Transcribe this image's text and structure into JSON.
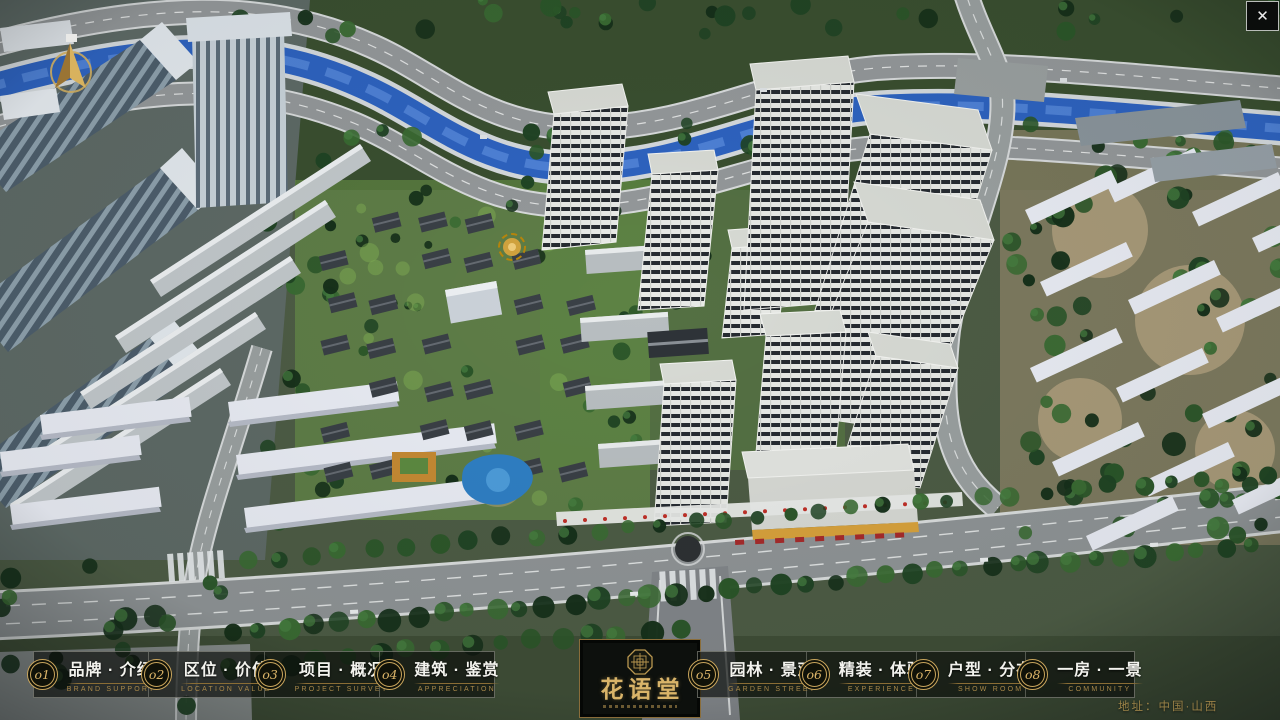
{
  "nav": {
    "items": [
      {
        "num": "o1",
        "zh": "品牌 · 介绍",
        "en": "BRAND SUPPORT"
      },
      {
        "num": "o2",
        "zh": "区位 · 价值",
        "en": "LOCATION VALUE"
      },
      {
        "num": "o3",
        "zh": "项目 · 概况",
        "en": "PROJECT SURVEY"
      },
      {
        "num": "o4",
        "zh": "建筑 · 鉴赏",
        "en": "APPRECIATION"
      },
      {
        "num": "o5",
        "zh": "园林 · 景观",
        "en": "GARDEN STREET"
      },
      {
        "num": "o6",
        "zh": "精装 · 体验",
        "en": "EXPERIENCE"
      },
      {
        "num": "o7",
        "zh": "户型 · 分布",
        "en": "SHOW ROOM"
      },
      {
        "num": "o8",
        "zh": "一房 · 一景",
        "en": "COMMUNITY"
      }
    ]
  },
  "logo": {
    "title_zh": "花语堂"
  },
  "footer": {
    "address": "地址：中国·山西"
  },
  "window": {
    "close_label": "✕"
  },
  "colors": {
    "gold": "#c9a55c",
    "bar_bg": "rgba(12,15,12,0.68)",
    "river": "#2e63c0"
  }
}
